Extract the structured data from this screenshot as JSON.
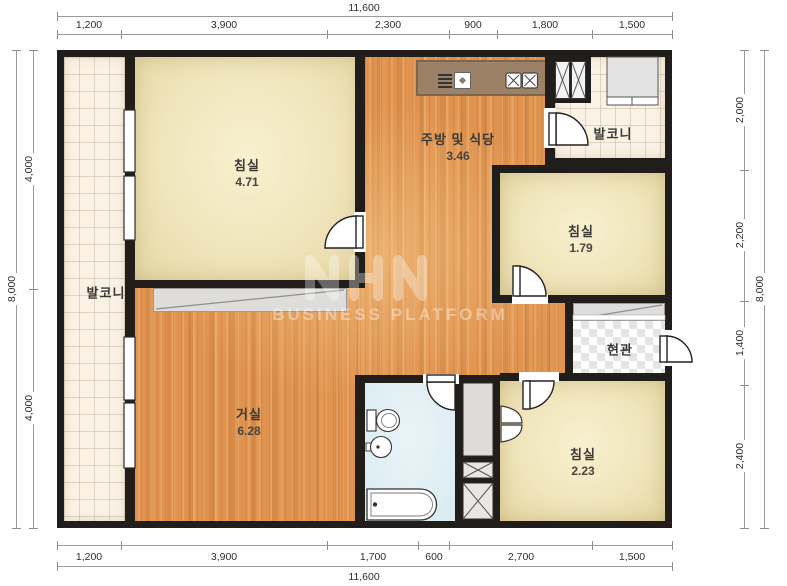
{
  "watermark": {
    "logo": "NHN",
    "text": "BUSINESS PLATFORM"
  },
  "dims": {
    "top": {
      "total": "11,600",
      "seg": [
        "1,200",
        "3,900",
        "2,300",
        "900",
        "1,800",
        "1,500"
      ]
    },
    "bottom": {
      "total": "11,600",
      "seg": [
        "1,200",
        "3,900",
        "1,700",
        "600",
        "2,700",
        "1,500"
      ]
    },
    "left": {
      "total": "8,000",
      "seg": [
        "4,000",
        "4,000"
      ]
    },
    "right": {
      "total": "8,000",
      "seg": [
        "2,000",
        "2,200",
        "1,400",
        "2,400"
      ]
    }
  },
  "rooms": {
    "bedroom_main": {
      "name": "침실",
      "area": "4.71"
    },
    "kitchen_dining": {
      "name": "주방 및 식당",
      "area": "3.46"
    },
    "balcony_top_right": {
      "name": "발코니"
    },
    "bedroom_middle": {
      "name": "침실",
      "area": "1.79"
    },
    "entrance_hall": {
      "name": "현관"
    },
    "bedroom_small": {
      "name": "침실",
      "area": "2.23"
    },
    "living_room": {
      "name": "거실",
      "area": "6.28"
    },
    "balcony_left": {
      "name": "발코니"
    }
  },
  "icons": {
    "range_hood": "range-hood-icon",
    "kitchen_sink": "kitchen-sink-icon",
    "gas_stove": "gas-stove-icon",
    "toilet": "toilet-icon",
    "washbasin": "washbasin-icon",
    "bathtub": "bathtub-icon"
  },
  "colors": {
    "wall": "#201d1a",
    "wood_floor": "#e0934e",
    "bedroom_floor": "#f0e5bb",
    "balcony_tile": "#faf2e4",
    "bathroom_floor": "#dcedf2",
    "counter": "#9c8166"
  }
}
